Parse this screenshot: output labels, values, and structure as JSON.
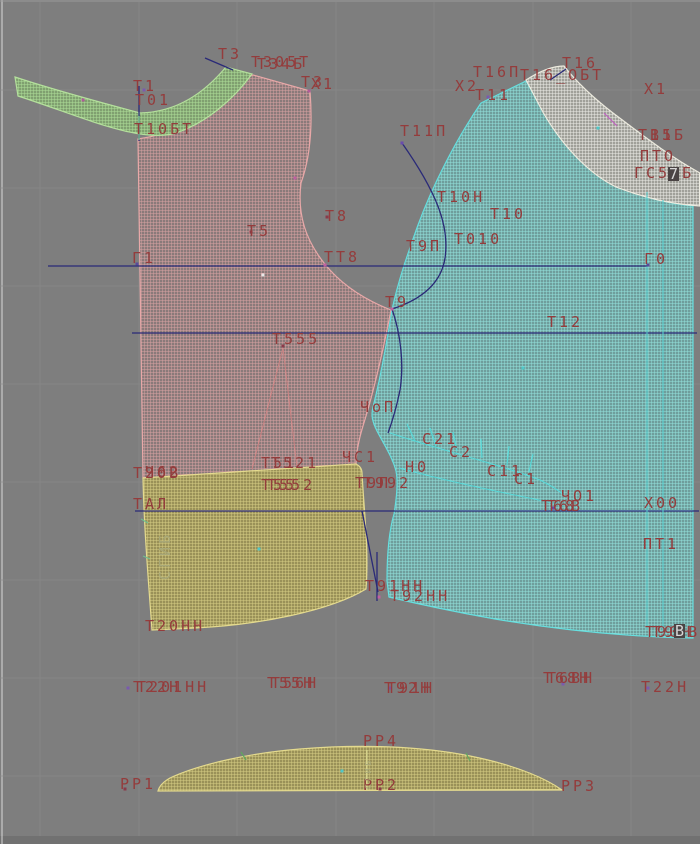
{
  "app": {
    "name": "pattern-cad-canvas",
    "description_not_rendered": ""
  },
  "canvas": {
    "width": 700,
    "height": 844,
    "bg": "#7e7e7e",
    "grid_color": "#8b8b8b",
    "edge_left": "#d8d8d8",
    "edge_top": "#9b9b9b",
    "bottom_bar": "#717171"
  },
  "colors": {
    "label_text": "#943c3c",
    "fold_text": "#a8a878",
    "navy_line": "#2a2a78",
    "cyan_line": "#58d8d8",
    "pink_line": "#cc8484",
    "green_tick": "#60a860",
    "magenta_tick": "#c060c0",
    "piece_collar": "#9cbc88",
    "piece_front": "#bd8e8e",
    "piece_back": "#85c2c0",
    "piece_facing": "#c9c8c2",
    "piece_skirt": "#b5ad6e"
  },
  "grid": {
    "vx": [
      40,
      139,
      237,
      336,
      434,
      533,
      631
    ],
    "hy": [
      90,
      188,
      286,
      384,
      482,
      580,
      678,
      776
    ]
  },
  "construction": {
    "navy_lines": [
      [
        48,
        266,
        648,
        266
      ],
      [
        132,
        333,
        697,
        333
      ],
      [
        135,
        511,
        699,
        511
      ],
      [
        362,
        511,
        378,
        592
      ],
      [
        377,
        552,
        377,
        601
      ],
      [
        205,
        58,
        233,
        70
      ],
      [
        550,
        80,
        566,
        69
      ],
      [
        139,
        86,
        139,
        141
      ]
    ],
    "navy_curves": [
      "M402,143 C435,190 450,225 445,258 C441,284 420,300 392,309",
      "M392,309 C401,335 404,365 400,390 C396,410 392,422 388,433"
    ],
    "pink_lines": [
      [
        283,
        348,
        252,
        469
      ],
      [
        283,
        348,
        297,
        467
      ]
    ],
    "cyan_lines": [
      [
        647,
        192,
        647,
        630
      ],
      [
        663,
        200,
        663,
        633
      ]
    ],
    "cyan_curves": [
      "M390,433 C440,450 495,463 540,480 C550,485 558,490 564,495",
      "M399,468 C450,482 500,492 548,502 C554,503 560,505 564,506"
    ],
    "notch_ticks": [
      [
        415,
        441,
        407,
        424
      ],
      [
        436,
        446,
        430,
        428
      ],
      [
        457,
        451,
        453,
        432
      ],
      [
        482,
        458,
        481,
        439
      ],
      [
        507,
        465,
        509,
        446
      ],
      [
        529,
        472,
        533,
        454
      ]
    ],
    "edge_ticks": [
      [
        141,
        519,
        148,
        523
      ],
      [
        143,
        556,
        150,
        559
      ],
      [
        139,
        116,
        139,
        140
      ]
    ],
    "strip_ticks": [
      [
        241,
        752,
        246,
        760
      ],
      [
        466,
        753,
        470,
        761
      ]
    ],
    "band_ticks": [
      [
        604,
        113,
        617,
        126
      ]
    ],
    "yellow_lines": [
      [
        367,
        750,
        367,
        790
      ]
    ]
  },
  "markers": [
    {
      "x": 137,
      "y": 264,
      "c": "#5a4a9a"
    },
    {
      "x": 144,
      "y": 90,
      "c": "#7a5aae"
    },
    {
      "x": 83,
      "y": 100,
      "c": "#b05a9a"
    },
    {
      "x": 295,
      "y": 178,
      "c": "#c060a0"
    },
    {
      "x": 309,
      "y": 91,
      "c": "#b05a9a"
    },
    {
      "x": 251,
      "y": 232,
      "c": "#8a3a4a"
    },
    {
      "x": 327,
      "y": 217,
      "c": "#8a3a4a"
    },
    {
      "x": 392,
      "y": 309,
      "c": "#c060a0"
    },
    {
      "x": 283,
      "y": 346,
      "c": "#8a3a4a"
    },
    {
      "x": 402,
      "y": 143,
      "c": "#6a4aae"
    },
    {
      "x": 263,
      "y": 275,
      "c": "#e8e8e8"
    },
    {
      "x": 325,
      "y": 265,
      "c": "#c060a0"
    },
    {
      "x": 648,
      "y": 265,
      "c": "#5a4a9a"
    },
    {
      "x": 598,
      "y": 128,
      "c": "#50c8c8"
    },
    {
      "x": 523,
      "y": 368,
      "c": "#50c8c8"
    },
    {
      "x": 259,
      "y": 549,
      "c": "#50c8c8"
    },
    {
      "x": 342,
      "y": 771,
      "c": "#50c8c8"
    },
    {
      "x": 379,
      "y": 597,
      "c": "#c060a0"
    },
    {
      "x": 553,
      "y": 508,
      "c": "#6a4aae"
    },
    {
      "x": 488,
      "y": 97,
      "c": "#7a5aae"
    },
    {
      "x": 563,
      "y": 684,
      "c": "#7a5aae"
    },
    {
      "x": 128,
      "y": 688,
      "c": "#7a5aae"
    },
    {
      "x": 390,
      "y": 688,
      "c": "#7a5aae"
    },
    {
      "x": 648,
      "y": 688,
      "c": "#7a5aae"
    },
    {
      "x": 125,
      "y": 789,
      "c": "#8a3a4a"
    },
    {
      "x": 380,
      "y": 789,
      "c": "#8a3a4a"
    }
  ],
  "labels": [
    {
      "t": "Т3",
      "x": 218,
      "y": 47
    },
    {
      "t": "Т305Т",
      "x": 251,
      "y": 55
    },
    {
      "t": "Т34Б",
      "x": 257,
      "y": 57
    },
    {
      "t": "Т3",
      "x": 301,
      "y": 75
    },
    {
      "t": "Х1",
      "x": 311,
      "y": 77
    },
    {
      "t": "Т1",
      "x": 133,
      "y": 79
    },
    {
      "t": "Т01",
      "x": 135,
      "y": 93
    },
    {
      "t": "Т10БТ",
      "x": 134,
      "y": 122
    },
    {
      "t": "Т11П",
      "x": 400,
      "y": 124
    },
    {
      "t": "Х2",
      "x": 455,
      "y": 79
    },
    {
      "t": "Т11",
      "x": 475,
      "y": 88
    },
    {
      "t": "Т16П",
      "x": 473,
      "y": 65
    },
    {
      "t": "Т16_ОБТ",
      "x": 520,
      "y": 68
    },
    {
      "t": "Т16",
      "x": 562,
      "y": 56
    },
    {
      "t": "Х1",
      "x": 644,
      "y": 82
    },
    {
      "t": "Т15",
      "x": 638,
      "y": 128
    },
    {
      "t": "В1Б",
      "x": 650,
      "y": 128
    },
    {
      "t": "ПТО",
      "x": 640,
      "y": 149
    },
    {
      "t": "ГС51Б",
      "x": 634,
      "y": 166
    },
    {
      "t": "7",
      "x": 668,
      "y": 167,
      "c": "box"
    },
    {
      "t": "Т10Н",
      "x": 437,
      "y": 190
    },
    {
      "t": "Т10",
      "x": 490,
      "y": 207
    },
    {
      "t": "Т010",
      "x": 454,
      "y": 232
    },
    {
      "t": "Т9П",
      "x": 406,
      "y": 239
    },
    {
      "t": "Т8",
      "x": 325,
      "y": 209
    },
    {
      "t": "Т5",
      "x": 247,
      "y": 224
    },
    {
      "t": "Г1",
      "x": 132,
      "y": 251
    },
    {
      "t": "ТТ8",
      "x": 324,
      "y": 250
    },
    {
      "t": "Г0",
      "x": 644,
      "y": 252
    },
    {
      "t": "Т9",
      "x": 385,
      "y": 295
    },
    {
      "t": "Т12",
      "x": 547,
      "y": 315
    },
    {
      "t": "Т555",
      "x": 272,
      "y": 332
    },
    {
      "t": "ЧоП",
      "x": 360,
      "y": 400
    },
    {
      "t": "С21",
      "x": 422,
      "y": 432
    },
    {
      "t": "С2",
      "x": 449,
      "y": 445
    },
    {
      "t": "С11",
      "x": 487,
      "y": 464
    },
    {
      "t": "С1",
      "x": 514,
      "y": 472
    },
    {
      "t": "Н0",
      "x": 405,
      "y": 460
    },
    {
      "t": "ЧС1",
      "x": 342,
      "y": 450
    },
    {
      "t": "Т51",
      "x": 261,
      "y": 456
    },
    {
      "t": "Т521",
      "x": 271,
      "y": 456
    },
    {
      "t": "Т55",
      "x": 261,
      "y": 478
    },
    {
      "t": "Т552",
      "x": 267,
      "y": 478
    },
    {
      "t": "Т20В",
      "x": 133,
      "y": 466
    },
    {
      "t": "Ч62",
      "x": 145,
      "y": 465
    },
    {
      "t": "ТАЛ",
      "x": 133,
      "y": 497
    },
    {
      "t": "Т9П",
      "x": 355,
      "y": 476
    },
    {
      "t": "Т992",
      "x": 363,
      "y": 476
    },
    {
      "t": "Т20НН",
      "x": 145,
      "y": 619
    },
    {
      "t": "Т91НН",
      "x": 365,
      "y": 579
    },
    {
      "t": "Т92НН",
      "x": 390,
      "y": 589
    },
    {
      "t": "Т68",
      "x": 541,
      "y": 499
    },
    {
      "t": "Т6В",
      "x": 547,
      "y": 499
    },
    {
      "t": "ЧО1",
      "x": 561,
      "y": 489
    },
    {
      "t": "Х00",
      "x": 644,
      "y": 496
    },
    {
      "t": "ПТ1",
      "x": 643,
      "y": 537
    },
    {
      "t": "Т90Н",
      "x": 645,
      "y": 625
    },
    {
      "t": "Т90В",
      "x": 652,
      "y": 625
    },
    {
      "t": "В",
      "x": 674,
      "y": 624,
      "c": "box"
    },
    {
      "t": "Т22Н",
      "x": 133,
      "y": 680
    },
    {
      "t": "Т201НН",
      "x": 137,
      "y": 680
    },
    {
      "t": "Т55Н",
      "x": 267,
      "y": 676
    },
    {
      "t": "Т56Н",
      "x": 271,
      "y": 676
    },
    {
      "t": "Т92Н",
      "x": 384,
      "y": 681
    },
    {
      "t": "Т91Н",
      "x": 387,
      "y": 681
    },
    {
      "t": "Т68Н",
      "x": 543,
      "y": 671
    },
    {
      "t": "Т6ВН",
      "x": 547,
      "y": 671
    },
    {
      "t": "Т22Н",
      "x": 641,
      "y": 680
    },
    {
      "t": "РР4",
      "x": 363,
      "y": 734
    },
    {
      "t": "РР1",
      "x": 120,
      "y": 777
    },
    {
      "t": "РР2",
      "x": 363,
      "y": 778
    },
    {
      "t": "РР3",
      "x": 561,
      "y": 779
    },
    {
      "t": "СГИБ",
      "x": 158,
      "y": 580,
      "r": -90,
      "c": "fold"
    },
    {
      "t": "СГИБ",
      "x": 362,
      "y": 789,
      "r": -90,
      "c": "fold",
      "s": 8
    }
  ]
}
